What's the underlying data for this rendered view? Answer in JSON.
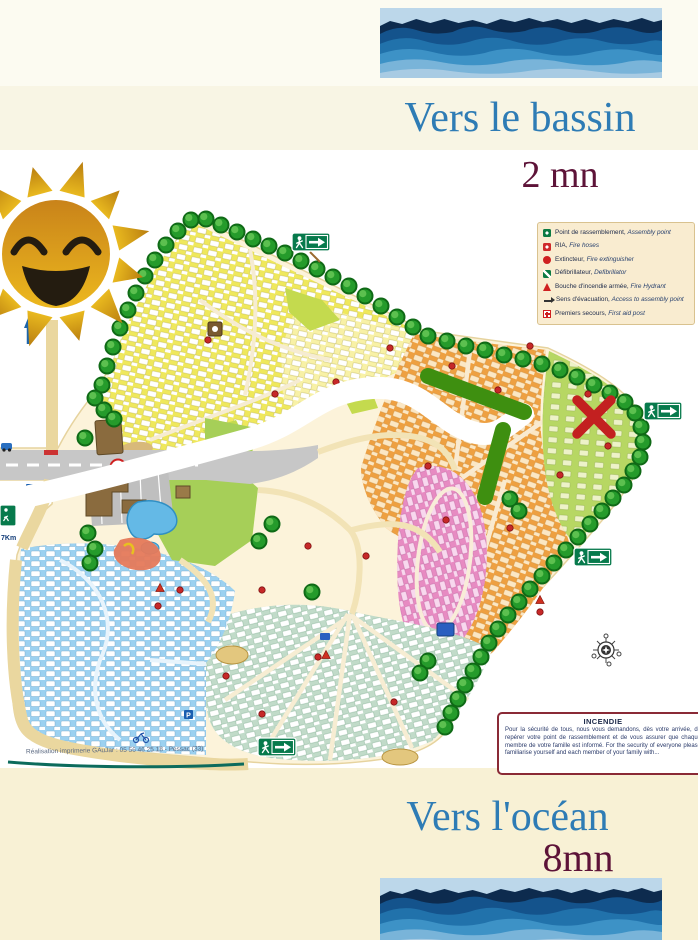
{
  "page": {
    "width": 698,
    "height": 940
  },
  "colors": {
    "heading_blue": "#2e7cb5",
    "duration_maroon": "#5d1338",
    "route_white": "#ffffff",
    "direction_green": "#3e8f10",
    "destination_marker_red": "#c32020"
  },
  "header": {
    "destination": "Vers le bassin",
    "duration": "2 mn"
  },
  "footer": {
    "destination": "Vers l'océan",
    "duration": "8mn"
  },
  "map": {
    "speed_sign": "10",
    "distance_label": "7Km",
    "parking_label": "P",
    "credit_line": "Réalisation imprimerie GAuJar : 05 56 46 25 18 - Pessac (33)",
    "legend": {
      "items": [
        {
          "name": "assembly-point",
          "fr": "Point de rassemblement,",
          "en": "Assembly point"
        },
        {
          "name": "fire-hoses",
          "fr": "RIA,",
          "en": "Fire hoses"
        },
        {
          "name": "fire-extinguisher",
          "fr": "Extincteur,",
          "en": "Fire extinguisher"
        },
        {
          "name": "defibrillator",
          "fr": "Défibrillateur,",
          "en": "Defibrillator"
        },
        {
          "name": "fire-hydrant",
          "fr": "Bouche d'incendie armée,",
          "en": "Fire Hydrant"
        },
        {
          "name": "evacuation-direction",
          "fr": "Sens d'évacuation,",
          "en": "Access to assembly point"
        },
        {
          "name": "first-aid",
          "fr": "Premiers secours,",
          "en": "First aid post"
        }
      ]
    },
    "incendie": {
      "title": "INCENDIE",
      "body": "Pour la sécurité de tous, nous vous demandons, dès votre arrivée, de repérer votre point de rassemblement et de vous assurer que chaque membre de votre famille est informé. For the security of everyone please familiarise yourself and each member of your family with..."
    }
  }
}
